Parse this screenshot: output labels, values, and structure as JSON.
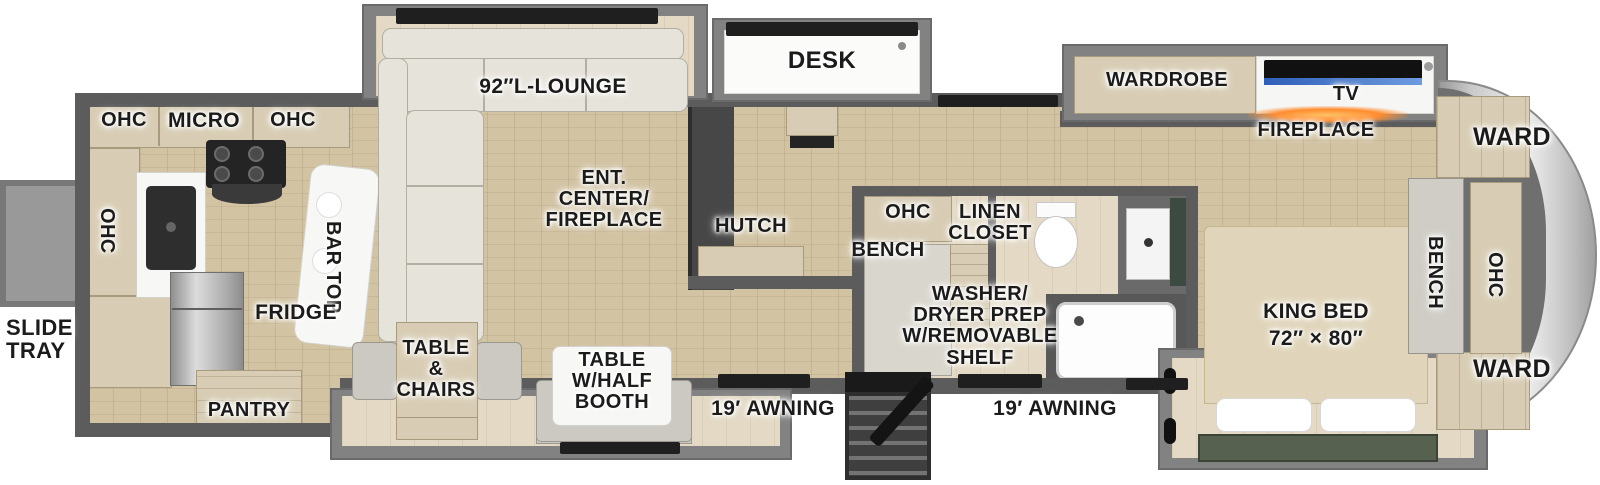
{
  "exterior": {
    "slide_tray": "SLIDE\nTRAY",
    "awning_left": "19′ AWNING",
    "awning_right": "19′ AWNING"
  },
  "kitchen": {
    "ohc_left": "OHC",
    "micro": "MICRO",
    "ohc_right": "OHC",
    "ohc_side": "OHC",
    "bar_top": "BAR TOP",
    "fridge": "FRIDGE",
    "pantry": "PANTRY"
  },
  "living": {
    "lounge": "92″L-LOUNGE",
    "ent_center": "ENT.\nCENTER/\nFIREPLACE",
    "table_chairs": "TABLE\n&\nCHAIRS",
    "table_booth": "TABLE\nW/HALF\nBOOTH"
  },
  "office": {
    "desk": "DESK",
    "hutch": "HUTCH"
  },
  "bath": {
    "ohc": "OHC",
    "bench": "BENCH",
    "linen_closet": "LINEN\nCLOSET",
    "washer": "WASHER/\nDRYER PREP\nW/REMOVABLE\nSHELF"
  },
  "bedroom": {
    "wardrobe": "WARDROBE",
    "tv": "TV",
    "fireplace": "FIREPLACE",
    "king_bed": "KING BED\n72″ × 80″"
  },
  "front_cap": {
    "ward_top": "WARD",
    "bench": "BENCH",
    "ohc": "OHC",
    "ward_bottom": "WARD"
  },
  "colors": {
    "wall": "#5c5c5c",
    "floor_wood": "#d2c3a3",
    "slide_floor": "#e3d9c4",
    "cabinet_wood": "#d8cdb4",
    "counter_white": "#f7f7f5",
    "appliance_dark": "#242424",
    "sofa_fabric": "#e6e3da",
    "bed_footboard_green": "#57614f",
    "tv_screen_blue": "#3f74cf",
    "fireplace_orange": "#ff8c2e",
    "front_cap_silver": "#d9d9d9"
  }
}
